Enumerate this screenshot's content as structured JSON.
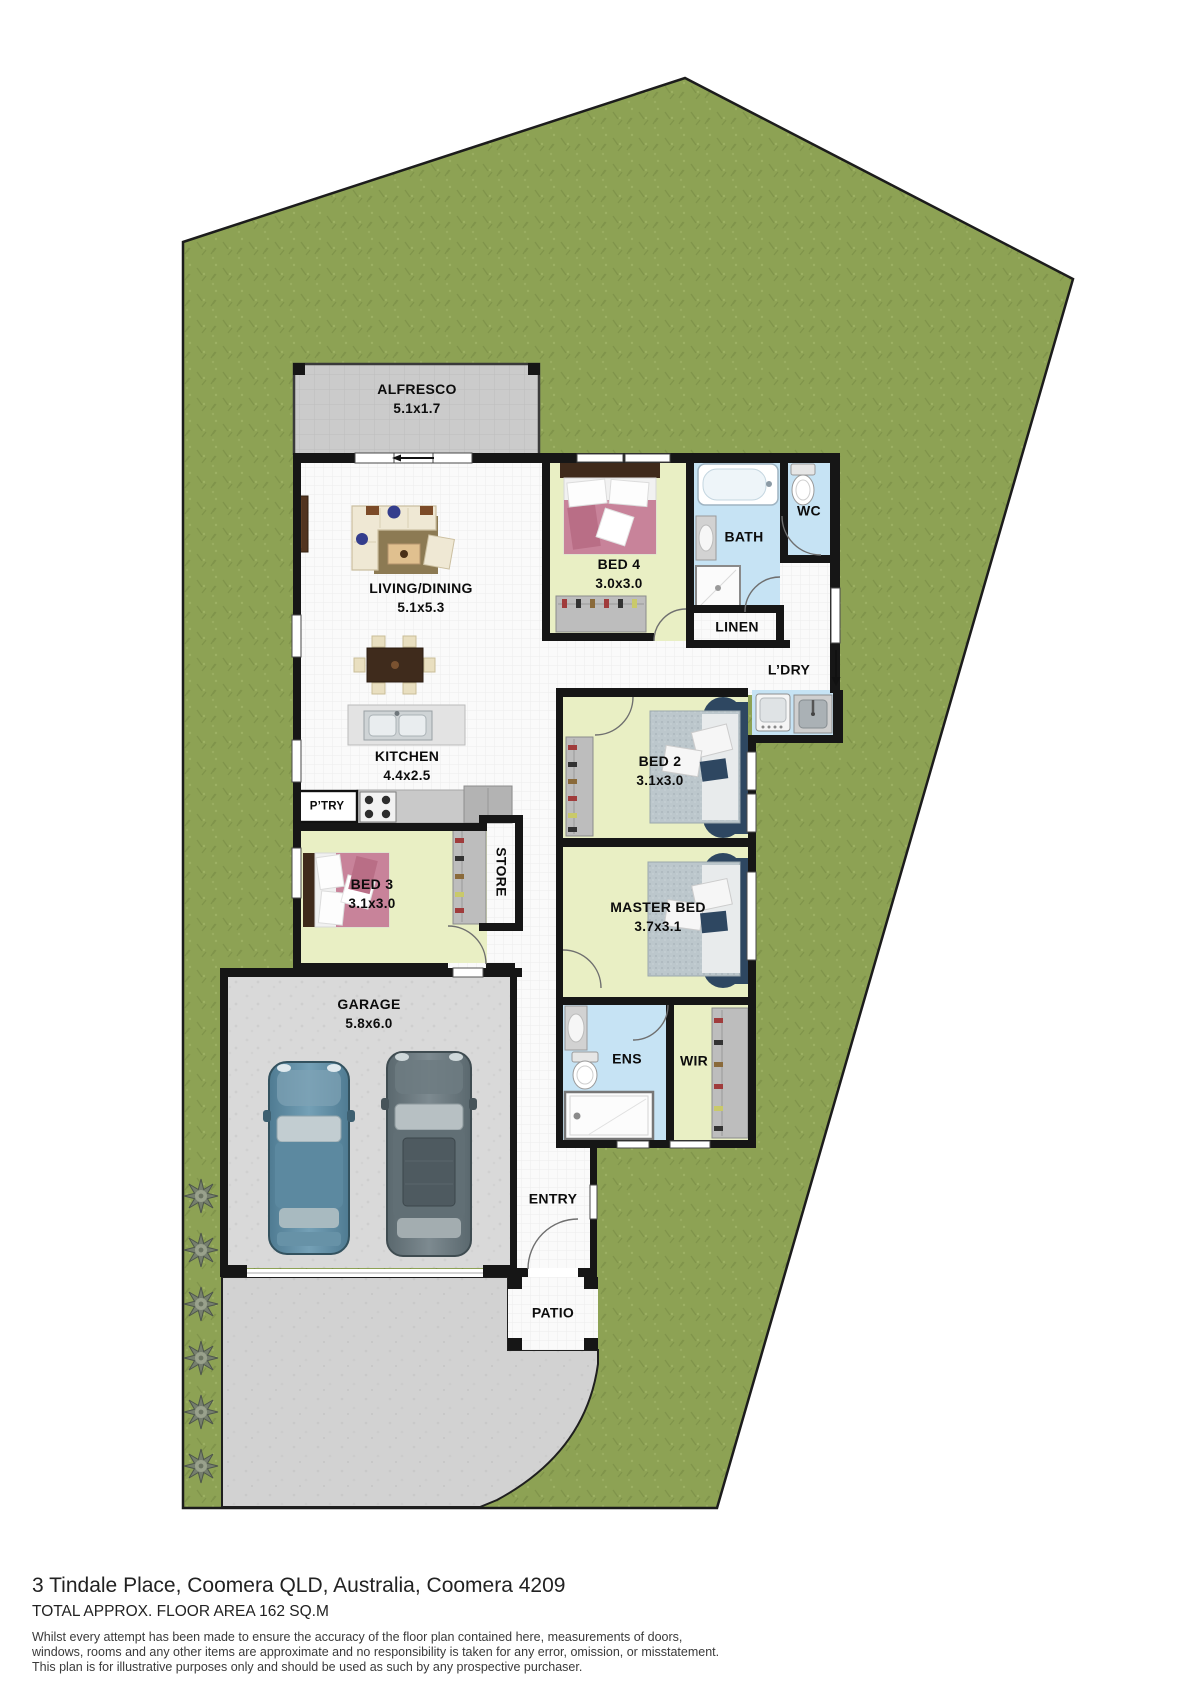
{
  "title": "Floor plan",
  "colors": {
    "grass": "#8da254",
    "wall": "#161616",
    "floor": "#fafafa",
    "bedroom_fill": "#e9efc4",
    "wet_area_fill": "#c6e3f4",
    "alfresco_slab": "#cbcbcb",
    "garage_floor": "#d9d9d9",
    "driveway": "#d2d2d2",
    "bed_pink": "#c8839a",
    "bed_blue_dark": "#2e4761",
    "car_blue": "#5b87a2",
    "car_gray": "#68767c"
  },
  "rooms": [
    {
      "id": "alfresco",
      "label": "ALFRESCO",
      "dims": "5.1x1.7",
      "x": 417,
      "y": 390
    },
    {
      "id": "living-dining",
      "label": "LIVING/DINING",
      "dims": "5.1x5.3",
      "x": 421,
      "y": 589
    },
    {
      "id": "bed4",
      "label": "BED 4",
      "dims": "3.0x3.0",
      "x": 619,
      "y": 565
    },
    {
      "id": "bath",
      "label": "BATH",
      "dims": "",
      "x": 744,
      "y": 537
    },
    {
      "id": "wc",
      "label": "WC",
      "dims": "",
      "x": 809,
      "y": 511
    },
    {
      "id": "linen",
      "label": "LINEN",
      "dims": "",
      "x": 737,
      "y": 627
    },
    {
      "id": "ldry",
      "label": "L’DRY",
      "dims": "",
      "x": 789,
      "y": 670
    },
    {
      "id": "kitchen",
      "label": "KITCHEN",
      "dims": "4.4x2.5",
      "x": 407,
      "y": 757
    },
    {
      "id": "ptry",
      "label": "P’TRY",
      "dims": "",
      "x": 327,
      "y": 807,
      "small": true
    },
    {
      "id": "bed2",
      "label": "BED 2",
      "dims": "3.1x3.0",
      "x": 660,
      "y": 762
    },
    {
      "id": "master-bed",
      "label": "MASTER BED",
      "dims": "3.7x3.1",
      "x": 658,
      "y": 908
    },
    {
      "id": "bed3",
      "label": "BED 3",
      "dims": "3.1x3.0",
      "x": 372,
      "y": 885
    },
    {
      "id": "store",
      "label": "STORE",
      "dims": "",
      "x": 501,
      "y": 872,
      "vertical": true
    },
    {
      "id": "ens",
      "label": "ENS",
      "dims": "",
      "x": 627,
      "y": 1059
    },
    {
      "id": "wir",
      "label": "WIR",
      "dims": "",
      "x": 694,
      "y": 1061
    },
    {
      "id": "garage",
      "label": "GARAGE",
      "dims": "5.8x6.0",
      "x": 369,
      "y": 1005
    },
    {
      "id": "entry",
      "label": "ENTRY",
      "dims": "",
      "x": 553,
      "y": 1199
    },
    {
      "id": "patio",
      "label": "PATIO",
      "dims": "",
      "x": 553,
      "y": 1313
    }
  ],
  "footer": {
    "address": "3 Tindale Place, Coomera QLD, Australia, Coomera 4209",
    "area": "TOTAL APPROX. FLOOR AREA 162 SQ.M",
    "disclaimer": [
      "Whilst every attempt has been made to ensure the accuracy of the floor plan contained here, measurements of doors,",
      "windows, rooms and any other items are approximate and no responsibility is taken for any error, omission, or misstatement.",
      "This plan is for illustrative purposes only and should be used as such by any prospective purchaser."
    ]
  }
}
